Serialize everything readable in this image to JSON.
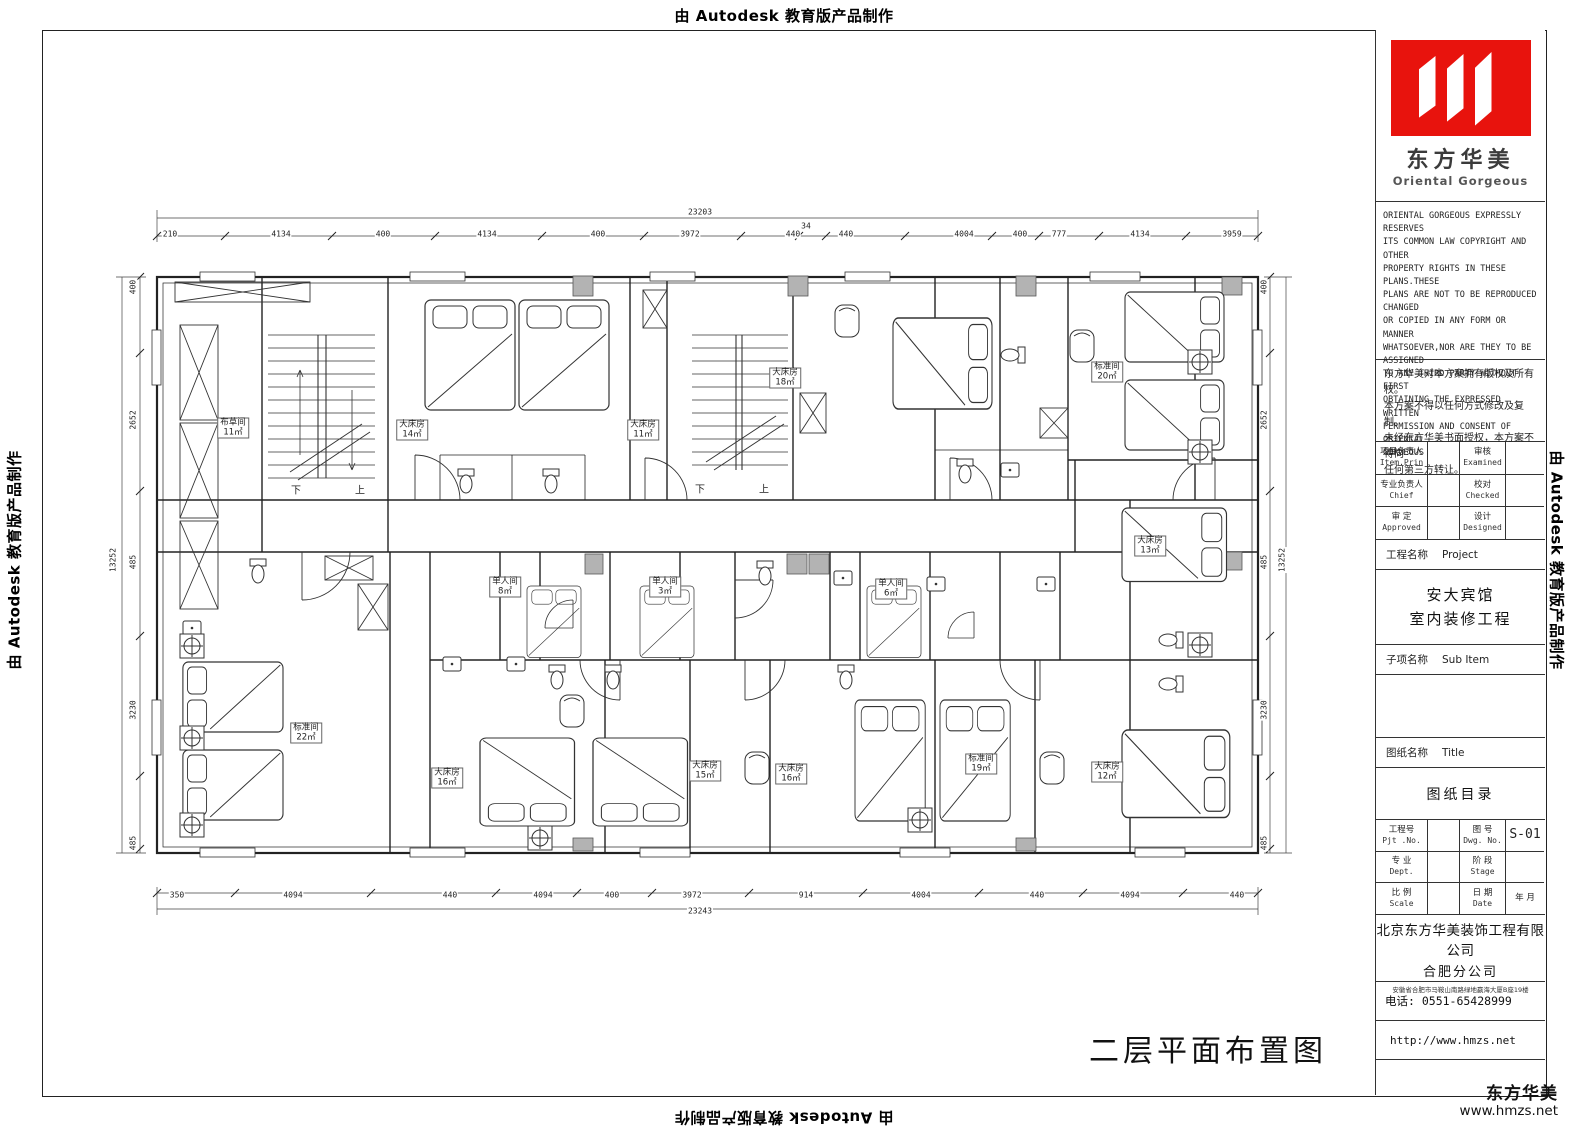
{
  "edge_marks": {
    "text": "由 Autodesk 教育版产品制作"
  },
  "title_block": {
    "logo": {
      "cn": "东方华美",
      "en": "Oriental Gorgeous",
      "red": "#e8130d"
    },
    "copyright_en_lines": [
      "ORIENTAL GORGEOUS EXPRESSLY RESERVES",
      "ITS COMMON LAW COPYRIGHT AND OTHER",
      "PROPERTY RIGHTS IN THESE PLANS.THESE",
      "PLANS ARE NOT TO BE REPRODUCED CHANGED",
      "OR COPIED IN ANY FORM OR MANNER",
      "WHATSOEVER,NOR ARE THEY TO BE ASSIGNED",
      "TO ANY THIRD PARTY WITHOUT FIRST",
      "OBTAINING THE EXPRESSED WRITTEN",
      "PERMISSION AND CONSENT OF ORIENTAL",
      "GORGEOUS"
    ],
    "copyright_cn_lines": [
      "东方华美对本方案拥有版权及所有权。",
      "本方案不得以任何方式修改及复制。",
      "未经东方华美书面授权，本方案不得向",
      "任何第三方转让。"
    ],
    "personnel_rows": [
      {
        "l1": "项目负责人",
        "l1en": "Item.Prin",
        "v1": "",
        "l2": "审核",
        "l2en": "Examined",
        "v2": ""
      },
      {
        "l1": "专业负责人",
        "l1en": "Chief",
        "v1": "",
        "l2": "校对",
        "l2en": "Checked",
        "v2": ""
      },
      {
        "l1": "审 定",
        "l1en": "Approved",
        "v1": "",
        "l2": "设计",
        "l2en": "Designed",
        "v2": ""
      }
    ],
    "project_label": "工程名称",
    "project_label_en": "Project",
    "project_name1": "安大宾馆",
    "project_name2": "室内装修工程",
    "subitem_label": "子项名称",
    "subitem_label_en": "Sub Item",
    "sheet_label": "图纸名称",
    "sheet_label_en": "Title",
    "sheet_title": "图纸目录",
    "info": {
      "pjt": "工程号",
      "pjt_en": "Pjt .No.",
      "pjt_val": "",
      "dwg": "图 号",
      "dwg_en": "Dwg. No.",
      "dwg_no": "S-01",
      "dept": "专 业",
      "dept_en": "Dept.",
      "dept_val": "",
      "stage": "阶 段",
      "stage_en": "Stage",
      "stage_val": "",
      "scale": "比 例",
      "scale_en": "Scale",
      "scale_val": "",
      "date": "日 期",
      "date_en": "Date",
      "date_val": "年    月"
    },
    "company1": "北京东方华美装饰工程有限公司",
    "company2": "合肥分公司",
    "address": "安徽省合肥市马鞍山南路绿地赢海大厦B座19楼",
    "phone": "电话: 0551-65428999",
    "website": "http://www.hmzs.net",
    "corner_cn": "东方华美",
    "corner_url": "www.hmzs.net"
  },
  "drawing_title": "二层平面布置图",
  "plan": {
    "rooms": [
      {
        "name": "布草间",
        "area": "11㎡",
        "x": 233,
        "y": 428
      },
      {
        "name": "大床房",
        "area": "14㎡",
        "x": 412,
        "y": 430
      },
      {
        "name": "大床房",
        "area": "11㎡",
        "x": 643,
        "y": 430
      },
      {
        "name": "大床房",
        "area": "18㎡",
        "x": 785,
        "y": 378
      },
      {
        "name": "标准间",
        "area": "20㎡",
        "x": 1107,
        "y": 372
      },
      {
        "name": "大床房",
        "area": "13㎡",
        "x": 1150,
        "y": 546
      },
      {
        "name": "单人间",
        "area": "8㎡",
        "x": 505,
        "y": 587
      },
      {
        "name": "单人间",
        "area": "3㎡",
        "x": 665,
        "y": 587
      },
      {
        "name": "单人间",
        "area": "6㎡",
        "x": 891,
        "y": 589
      },
      {
        "name": "标准间",
        "area": "22㎡",
        "x": 306,
        "y": 733
      },
      {
        "name": "大床房",
        "area": "16㎡",
        "x": 447,
        "y": 778
      },
      {
        "name": "大床房",
        "area": "15㎡",
        "x": 705,
        "y": 771
      },
      {
        "name": "大床房",
        "area": "16㎡",
        "x": 791,
        "y": 774
      },
      {
        "name": "标准间",
        "area": "19㎡",
        "x": 981,
        "y": 764
      },
      {
        "name": "大床房",
        "area": "12㎡",
        "x": 1107,
        "y": 772
      }
    ],
    "stairs": [
      {
        "t": "下",
        "x": 296,
        "y": 489
      },
      {
        "t": "上",
        "x": 360,
        "y": 489
      },
      {
        "t": "下",
        "x": 700,
        "y": 488
      },
      {
        "t": "上",
        "x": 764,
        "y": 488
      }
    ],
    "dims": {
      "top_total": {
        "v": "23203",
        "x": 700,
        "y": 212
      },
      "top": [
        {
          "v": "210",
          "x": 170,
          "y": 234
        },
        {
          "v": "4134",
          "x": 281,
          "y": 234
        },
        {
          "v": "400",
          "x": 383,
          "y": 234
        },
        {
          "v": "4134",
          "x": 487,
          "y": 234
        },
        {
          "v": "400",
          "x": 598,
          "y": 234
        },
        {
          "v": "3972",
          "x": 690,
          "y": 234
        },
        {
          "v": "440",
          "x": 793,
          "y": 234
        },
        {
          "v": "34",
          "x": 806,
          "y": 226
        },
        {
          "v": "440",
          "x": 846,
          "y": 234
        },
        {
          "v": "4004",
          "x": 964,
          "y": 234
        },
        {
          "v": "400",
          "x": 1020,
          "y": 234
        },
        {
          "v": "777",
          "x": 1059,
          "y": 234
        },
        {
          "v": "4134",
          "x": 1140,
          "y": 234
        },
        {
          "v": "3959",
          "x": 1232,
          "y": 234
        }
      ],
      "bottom_total": {
        "v": "23243",
        "x": 700,
        "y": 911
      },
      "bottom": [
        {
          "v": "350",
          "x": 177,
          "y": 895
        },
        {
          "v": "4094",
          "x": 293,
          "y": 895
        },
        {
          "v": "440",
          "x": 450,
          "y": 895
        },
        {
          "v": "4094",
          "x": 543,
          "y": 895
        },
        {
          "v": "400",
          "x": 612,
          "y": 895
        },
        {
          "v": "3972",
          "x": 692,
          "y": 895
        },
        {
          "v": "914",
          "x": 806,
          "y": 895
        },
        {
          "v": "4004",
          "x": 921,
          "y": 895
        },
        {
          "v": "440",
          "x": 1037,
          "y": 895
        },
        {
          "v": "4094",
          "x": 1130,
          "y": 895
        },
        {
          "v": "440",
          "x": 1237,
          "y": 895
        }
      ],
      "left_total": {
        "v": "13252",
        "x": 113,
        "y": 560
      },
      "left": [
        {
          "v": "400",
          "x": 133,
          "y": 287
        },
        {
          "v": "2652",
          "x": 133,
          "y": 420
        },
        {
          "v": "485",
          "x": 133,
          "y": 562
        },
        {
          "v": "3230",
          "x": 133,
          "y": 710
        },
        {
          "v": "485",
          "x": 133,
          "y": 843
        }
      ],
      "right_total": {
        "v": "13252",
        "x": 1282,
        "y": 560
      },
      "right": [
        {
          "v": "400",
          "x": 1264,
          "y": 287
        },
        {
          "v": "2652",
          "x": 1264,
          "y": 420
        },
        {
          "v": "485",
          "x": 1264,
          "y": 562
        },
        {
          "v": "3230",
          "x": 1264,
          "y": 710
        },
        {
          "v": "485",
          "x": 1264,
          "y": 843
        }
      ]
    }
  }
}
